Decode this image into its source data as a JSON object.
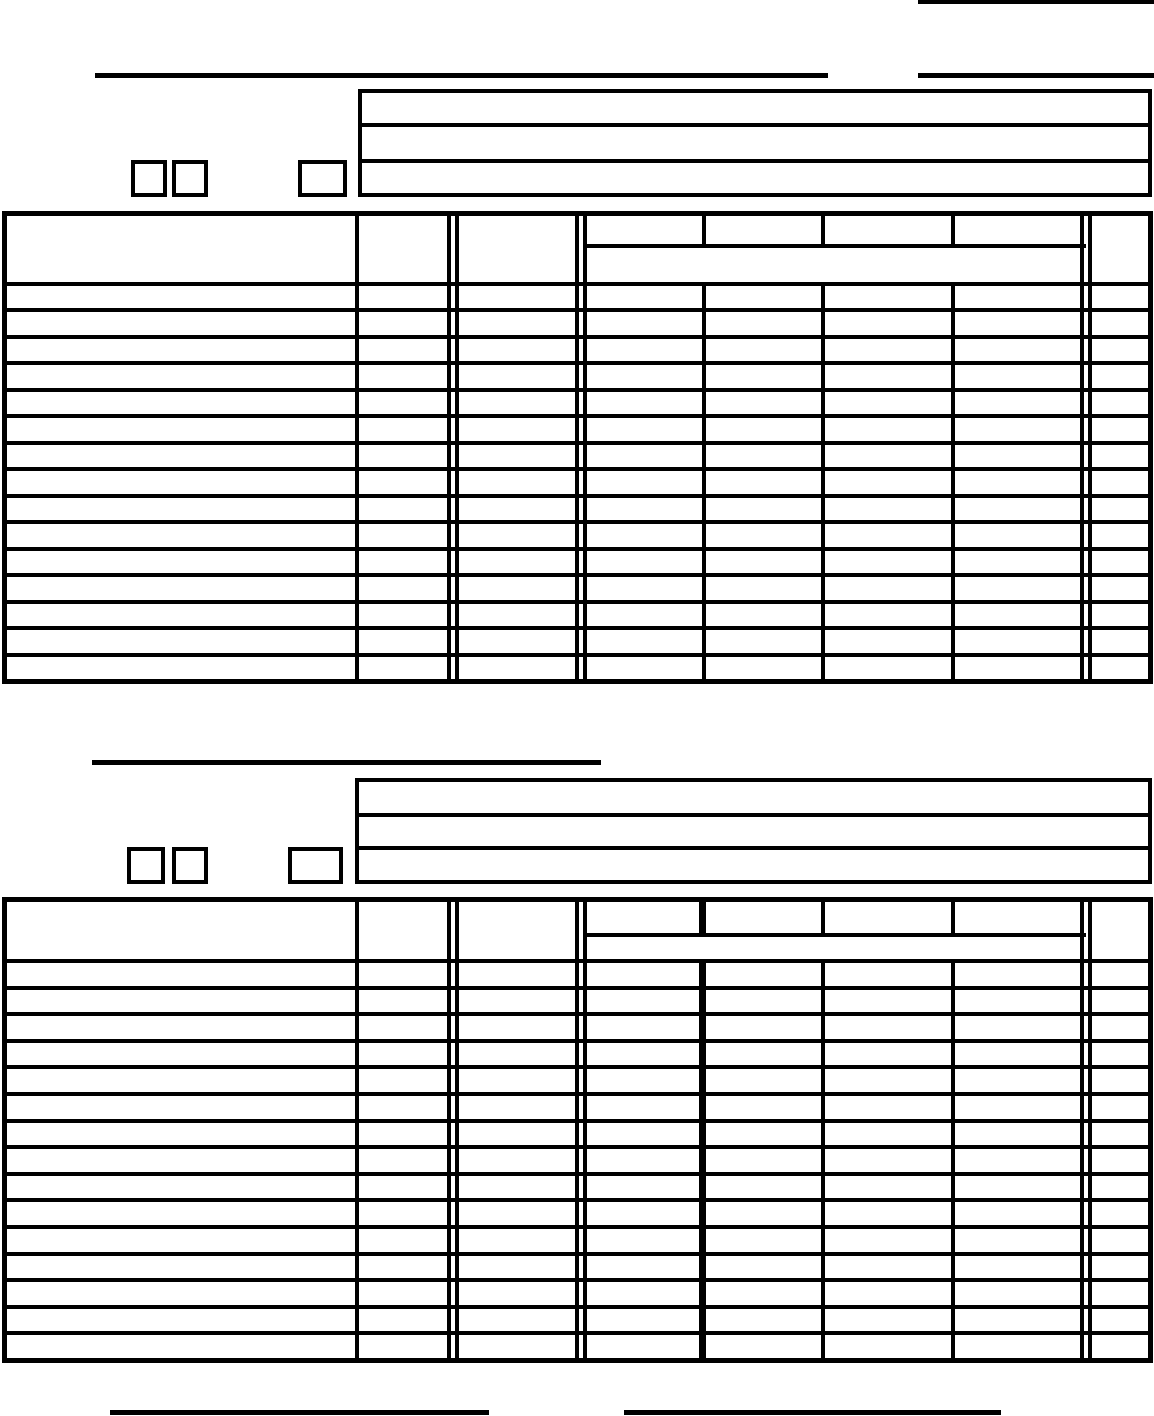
{
  "page": {
    "background_color": "#ffffff",
    "ink_color": "#000000"
  },
  "upper_section": {
    "blank_line_left_value": "",
    "blank_line_right_value": "",
    "info_box_lines": [
      "",
      "",
      ""
    ],
    "checkboxes": [
      {
        "checked": false
      },
      {
        "checked": false
      },
      {
        "checked": false
      }
    ],
    "table": {
      "body_row_count": 15,
      "column_count": 8,
      "header_labels": [
        "",
        "",
        "",
        "",
        "",
        "",
        "",
        ""
      ],
      "merged_subheader": "",
      "cells": []
    }
  },
  "lower_section": {
    "title_blank_line_value": "",
    "info_box_lines": [
      "",
      "",
      ""
    ],
    "checkboxes": [
      {
        "checked": false
      },
      {
        "checked": false
      },
      {
        "checked": false
      }
    ],
    "table": {
      "body_row_count": 15,
      "column_count": 8,
      "header_labels": [
        "",
        "",
        "",
        "",
        "",
        "",
        "",
        ""
      ],
      "merged_subheader": "",
      "cells": []
    }
  },
  "footer": {
    "blank_line_left_value": "",
    "blank_line_right_value": ""
  }
}
